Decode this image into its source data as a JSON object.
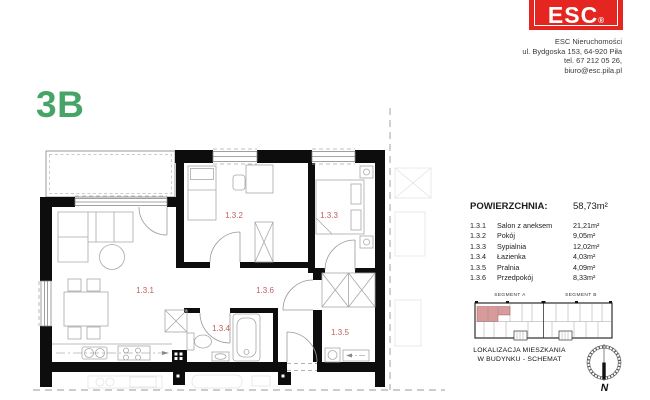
{
  "unit": {
    "code": "3B"
  },
  "logo": {
    "brand": "ESC",
    "registered": "®"
  },
  "company": {
    "name": "ESC Nieruchomości",
    "street": "ul. Bydgoska 153, 64-920 Piła",
    "phone": "tel. 67 212 05 26,",
    "email": "biuro@esc.pila.pl"
  },
  "area_table": {
    "header": "POWIERZCHNIA:",
    "total": "58,73m²",
    "rows": [
      {
        "num": "1.3.1",
        "name": "Salon z aneksem",
        "area": "21,21m²"
      },
      {
        "num": "1.3.2",
        "name": "Pokój",
        "area": "9,05m²"
      },
      {
        "num": "1.3.3",
        "name": "Sypialnia",
        "area": "12,02m²"
      },
      {
        "num": "1.3.4",
        "name": "Łazienka",
        "area": "4,03m²"
      },
      {
        "num": "1.3.5",
        "name": "Pralnia",
        "area": "4,09m²"
      },
      {
        "num": "1.3.6",
        "name": "Przedpokój",
        "area": "8,33m²"
      }
    ]
  },
  "floor_plan": {
    "rooms": {
      "r131": "1.3.1",
      "r132": "1.3.2",
      "r133": "1.3.3",
      "r134": "1.3.4",
      "r135": "1.3.5",
      "r136": "1.3.6"
    },
    "label_color": "#c05f5c"
  },
  "location_schematic": {
    "segment_a": "SEGMENT A",
    "segment_b": "SEGMENT B",
    "caption_line1": "LOKALIZACJA MIESZKANIA",
    "caption_line2": "W BUDYNKU - SCHEMAT",
    "compass": "N",
    "highlight_color": "#d89a9a"
  },
  "colors": {
    "accent_green": "#46a566",
    "brand_red": "#e52620",
    "wall": "#0d0d0d"
  }
}
